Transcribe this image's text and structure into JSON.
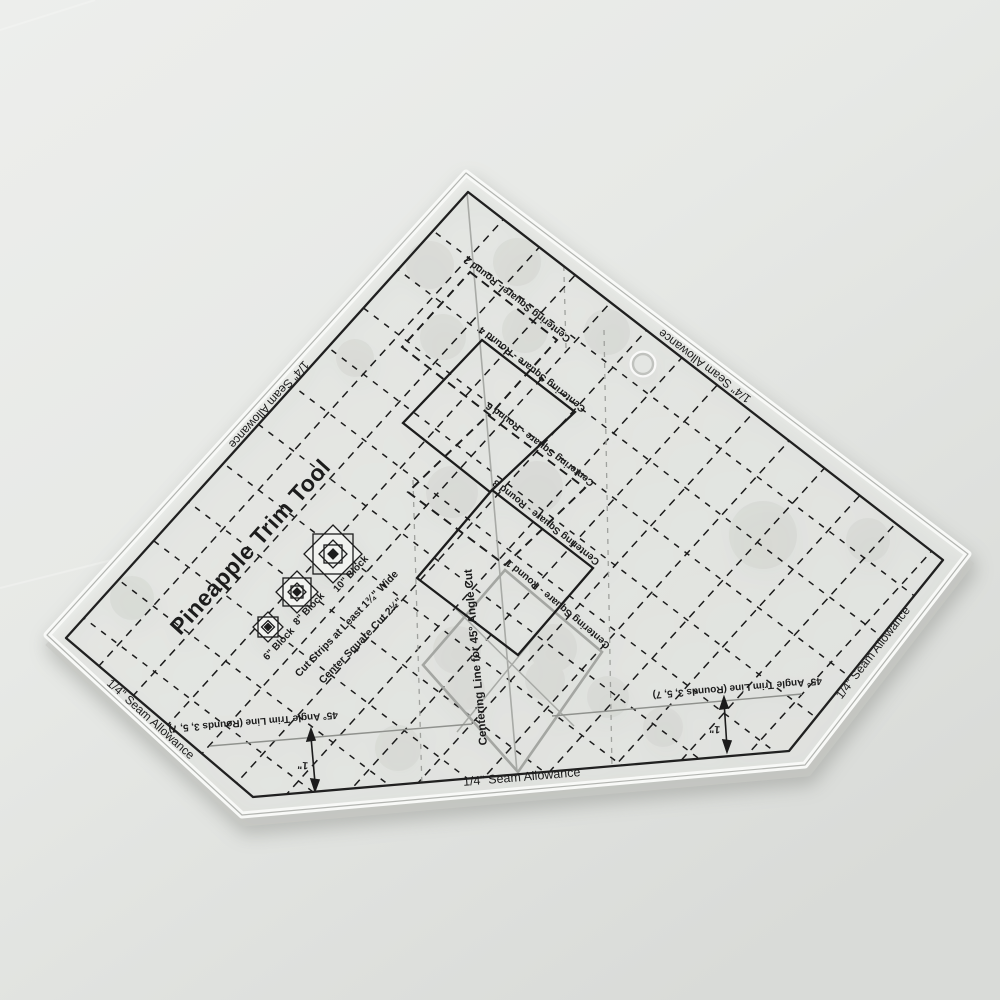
{
  "product": {
    "name": "Pineapple Trim Tool"
  },
  "labels": {
    "title": "Pineapple Trim Tool",
    "seam_allowance": "1/4\" Seam Allowance",
    "angle_trim": "45° Angle Trim Line (Rounds 3, 5, 7)",
    "one_inch": "1\"",
    "centering_line": "Centering Line for 45° Angle Cut",
    "instr_line1": "Cut Strips at Least 1¾\" Wide",
    "instr_line2": "Center Square Cut 2½\"",
    "block_6": "6\" Block",
    "block_8": "8\" Block",
    "block_10": "10\" Block",
    "round_2": "Centering Square - Round 2",
    "round_4": "Centering Square - Round 4",
    "round_6": "Centering Square - Round 6",
    "round_8": "Centering Square - Round 8",
    "round_1": "Centering Square - Round 1"
  },
  "colors": {
    "background": "#e8eae7",
    "ink": "#1c1c1c",
    "gray_ink": "#9fa19d",
    "acrylic_highlight": "#f8f9f7"
  }
}
